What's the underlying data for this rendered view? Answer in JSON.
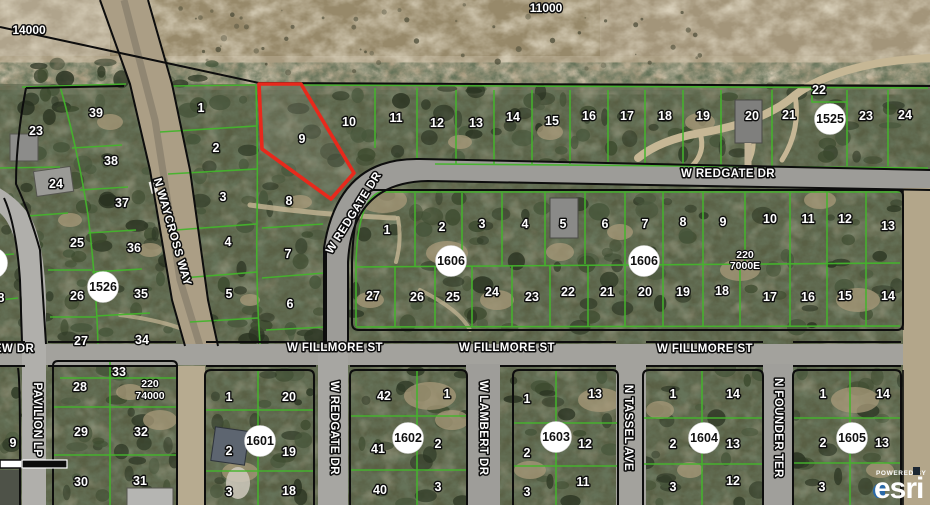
{
  "map": {
    "scale_annotations": [
      {
        "t": "14000",
        "x": 29,
        "y": 30
      },
      {
        "t": "11000",
        "x": 546,
        "y": 8
      }
    ],
    "dimension_notes": [
      {
        "lines": [
          "220",
          "74000"
        ],
        "x": 150,
        "y": 384,
        "lh": 12
      },
      {
        "lines": [
          "220",
          "7000E"
        ],
        "x": 745,
        "y": 255,
        "lh": 11
      }
    ],
    "street_labels": [
      {
        "t": "N WAYCROSS WAY",
        "x": 172,
        "y": 232,
        "rot": 74
      },
      {
        "t": "W REDGATE DR",
        "x": 728,
        "y": 174,
        "rot": 0
      },
      {
        "t": "W REDGATE DR",
        "x": 354,
        "y": 213,
        "rot": -58
      },
      {
        "t": "W REDGATE DR",
        "x": 334,
        "y": 428,
        "rot": 90
      },
      {
        "t": "W FILLMORE ST",
        "x": 335,
        "y": 348,
        "rot": 0
      },
      {
        "t": "W FILLMORE ST",
        "x": 507,
        "y": 348,
        "rot": 0
      },
      {
        "t": "W FILLMORE ST",
        "x": 705,
        "y": 349,
        "rot": 0
      },
      {
        "t": "W LAMBERT DR",
        "x": 483,
        "y": 428,
        "rot": 90
      },
      {
        "t": "N TASSEL AVE",
        "x": 628,
        "y": 428,
        "rot": 90
      },
      {
        "t": "N FOUNDER TER",
        "x": 778,
        "y": 428,
        "rot": 90
      },
      {
        "t": "PAVILION LP",
        "x": 37,
        "y": 420,
        "rot": 90
      },
      {
        "t": "EW DR",
        "x": 14,
        "y": 349,
        "rot": 0
      }
    ],
    "subdivision_circles": [
      {
        "t": "1525",
        "x": 830,
        "y": 119
      },
      {
        "t": "1526",
        "x": 103,
        "y": 287
      },
      {
        "t": "1606",
        "x": 451,
        "y": 261
      },
      {
        "t": "1606",
        "x": 644,
        "y": 261
      },
      {
        "t": "1601",
        "x": 260,
        "y": 441
      },
      {
        "t": "1602",
        "x": 408,
        "y": 438
      },
      {
        "t": "1603",
        "x": 556,
        "y": 437
      },
      {
        "t": "1604",
        "x": 704,
        "y": 438
      },
      {
        "t": "1605",
        "x": 852,
        "y": 438
      },
      {
        "t": "",
        "x": -8,
        "y": 263
      }
    ],
    "parcel_numbers": [
      {
        "t": "23",
        "x": 36,
        "y": 131
      },
      {
        "t": "24",
        "x": 56,
        "y": 184
      },
      {
        "t": "25",
        "x": 77,
        "y": 243
      },
      {
        "t": "26",
        "x": 77,
        "y": 296
      },
      {
        "t": "27",
        "x": 81,
        "y": 341
      },
      {
        "t": "28",
        "x": 80,
        "y": 387
      },
      {
        "t": "29",
        "x": 81,
        "y": 432
      },
      {
        "t": "30",
        "x": 81,
        "y": 482
      },
      {
        "t": "39",
        "x": 96,
        "y": 113
      },
      {
        "t": "38",
        "x": 111,
        "y": 161
      },
      {
        "t": "37",
        "x": 122,
        "y": 203
      },
      {
        "t": "36",
        "x": 134,
        "y": 248
      },
      {
        "t": "35",
        "x": 141,
        "y": 294
      },
      {
        "t": "34",
        "x": 142,
        "y": 340
      },
      {
        "t": "33",
        "x": 119,
        "y": 372
      },
      {
        "t": "32",
        "x": 141,
        "y": 432
      },
      {
        "t": "31",
        "x": 140,
        "y": 481
      },
      {
        "t": "8",
        "x": 1,
        "y": 298
      },
      {
        "t": "9",
        "x": 13,
        "y": 443
      },
      {
        "t": "1",
        "x": 201,
        "y": 108
      },
      {
        "t": "2",
        "x": 216,
        "y": 148
      },
      {
        "t": "3",
        "x": 223,
        "y": 197
      },
      {
        "t": "4",
        "x": 228,
        "y": 242
      },
      {
        "t": "5",
        "x": 229,
        "y": 294
      },
      {
        "t": "9",
        "x": 302,
        "y": 139
      },
      {
        "t": "8",
        "x": 289,
        "y": 201
      },
      {
        "t": "7",
        "x": 288,
        "y": 254
      },
      {
        "t": "6",
        "x": 290,
        "y": 304
      },
      {
        "t": "10",
        "x": 349,
        "y": 122
      },
      {
        "t": "11",
        "x": 396,
        "y": 118
      },
      {
        "t": "12",
        "x": 437,
        "y": 123
      },
      {
        "t": "13",
        "x": 476,
        "y": 123
      },
      {
        "t": "14",
        "x": 513,
        "y": 117
      },
      {
        "t": "15",
        "x": 552,
        "y": 121
      },
      {
        "t": "16",
        "x": 589,
        "y": 116
      },
      {
        "t": "17",
        "x": 627,
        "y": 116
      },
      {
        "t": "18",
        "x": 665,
        "y": 116
      },
      {
        "t": "19",
        "x": 703,
        "y": 116
      },
      {
        "t": "20",
        "x": 752,
        "y": 116
      },
      {
        "t": "21",
        "x": 789,
        "y": 115
      },
      {
        "t": "22",
        "x": 819,
        "y": 90
      },
      {
        "t": "23",
        "x": 866,
        "y": 116
      },
      {
        "t": "24",
        "x": 905,
        "y": 115
      },
      {
        "t": "1",
        "x": 387,
        "y": 230
      },
      {
        "t": "2",
        "x": 442,
        "y": 227
      },
      {
        "t": "3",
        "x": 482,
        "y": 224
      },
      {
        "t": "4",
        "x": 525,
        "y": 224
      },
      {
        "t": "5",
        "x": 563,
        "y": 224
      },
      {
        "t": "6",
        "x": 605,
        "y": 224
      },
      {
        "t": "7",
        "x": 645,
        "y": 224
      },
      {
        "t": "8",
        "x": 683,
        "y": 222
      },
      {
        "t": "9",
        "x": 723,
        "y": 222
      },
      {
        "t": "10",
        "x": 770,
        "y": 219
      },
      {
        "t": "11",
        "x": 808,
        "y": 219
      },
      {
        "t": "12",
        "x": 845,
        "y": 219
      },
      {
        "t": "13",
        "x": 888,
        "y": 226
      },
      {
        "t": "27",
        "x": 373,
        "y": 296
      },
      {
        "t": "26",
        "x": 417,
        "y": 297
      },
      {
        "t": "25",
        "x": 453,
        "y": 297
      },
      {
        "t": "24",
        "x": 492,
        "y": 292
      },
      {
        "t": "23",
        "x": 532,
        "y": 297
      },
      {
        "t": "22",
        "x": 568,
        "y": 292
      },
      {
        "t": "21",
        "x": 607,
        "y": 292
      },
      {
        "t": "20",
        "x": 645,
        "y": 292
      },
      {
        "t": "19",
        "x": 683,
        "y": 292
      },
      {
        "t": "18",
        "x": 722,
        "y": 291
      },
      {
        "t": "17",
        "x": 770,
        "y": 297
      },
      {
        "t": "16",
        "x": 808,
        "y": 297
      },
      {
        "t": "15",
        "x": 845,
        "y": 296
      },
      {
        "t": "14",
        "x": 888,
        "y": 296
      },
      {
        "t": "1",
        "x": 229,
        "y": 397
      },
      {
        "t": "20",
        "x": 289,
        "y": 397
      },
      {
        "t": "2",
        "x": 229,
        "y": 451
      },
      {
        "t": "19",
        "x": 289,
        "y": 452
      },
      {
        "t": "3",
        "x": 229,
        "y": 492
      },
      {
        "t": "18",
        "x": 289,
        "y": 491
      },
      {
        "t": "42",
        "x": 384,
        "y": 396
      },
      {
        "t": "1",
        "x": 447,
        "y": 394
      },
      {
        "t": "41",
        "x": 378,
        "y": 449
      },
      {
        "t": "2",
        "x": 438,
        "y": 444
      },
      {
        "t": "40",
        "x": 380,
        "y": 490
      },
      {
        "t": "3",
        "x": 438,
        "y": 487
      },
      {
        "t": "1",
        "x": 527,
        "y": 399
      },
      {
        "t": "13",
        "x": 595,
        "y": 394
      },
      {
        "t": "2",
        "x": 527,
        "y": 453
      },
      {
        "t": "12",
        "x": 585,
        "y": 444
      },
      {
        "t": "3",
        "x": 527,
        "y": 492
      },
      {
        "t": "11",
        "x": 583,
        "y": 482
      },
      {
        "t": "1",
        "x": 673,
        "y": 394
      },
      {
        "t": "14",
        "x": 733,
        "y": 394
      },
      {
        "t": "2",
        "x": 673,
        "y": 444
      },
      {
        "t": "13",
        "x": 733,
        "y": 444
      },
      {
        "t": "3",
        "x": 673,
        "y": 487
      },
      {
        "t": "12",
        "x": 733,
        "y": 481
      },
      {
        "t": "1",
        "x": 823,
        "y": 394
      },
      {
        "t": "14",
        "x": 883,
        "y": 394
      },
      {
        "t": "2",
        "x": 823,
        "y": 443
      },
      {
        "t": "13",
        "x": 882,
        "y": 443
      },
      {
        "t": "3",
        "x": 822,
        "y": 487
      }
    ],
    "highlight": {
      "color": "#e8291c",
      "points": [
        [
          259,
          84
        ],
        [
          301,
          84
        ],
        [
          354,
          173
        ],
        [
          331,
          199
        ],
        [
          262,
          149
        ]
      ]
    },
    "colors": {
      "parcel_line_green": "#44b52c",
      "boundary_black": "#0d0d0d",
      "highlight_red": "#e8291c"
    },
    "attribution": {
      "powered_by": "POWERED BY",
      "brand": "esri"
    }
  }
}
